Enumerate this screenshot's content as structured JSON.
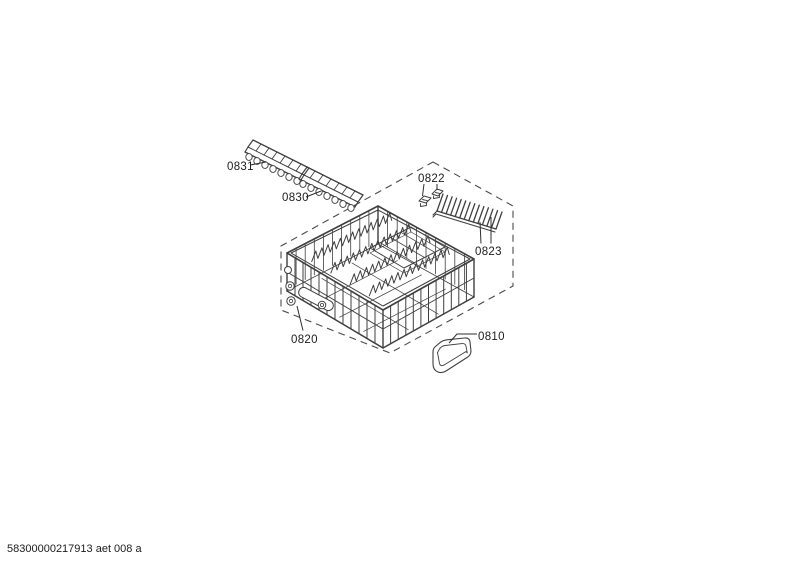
{
  "page": {
    "background": "#ffffff"
  },
  "art": {
    "line_color": "#3f3f3f",
    "label_color": "#1c1c1c",
    "boundary_color": "#4a4a4a",
    "boundary_style": "dashed"
  },
  "footer": {
    "doc_code": "58300000217913 aet 008 a"
  },
  "parts": {
    "tine_row_upper": {
      "label": "0831"
    },
    "tine_row_lower": {
      "label": "0830"
    },
    "clip_pair": {
      "label": "0822"
    },
    "fold_down_rack": {
      "label": "0823"
    },
    "lower_basket": {
      "label": "0820"
    },
    "tray_insert": {
      "label": "0810"
    }
  }
}
